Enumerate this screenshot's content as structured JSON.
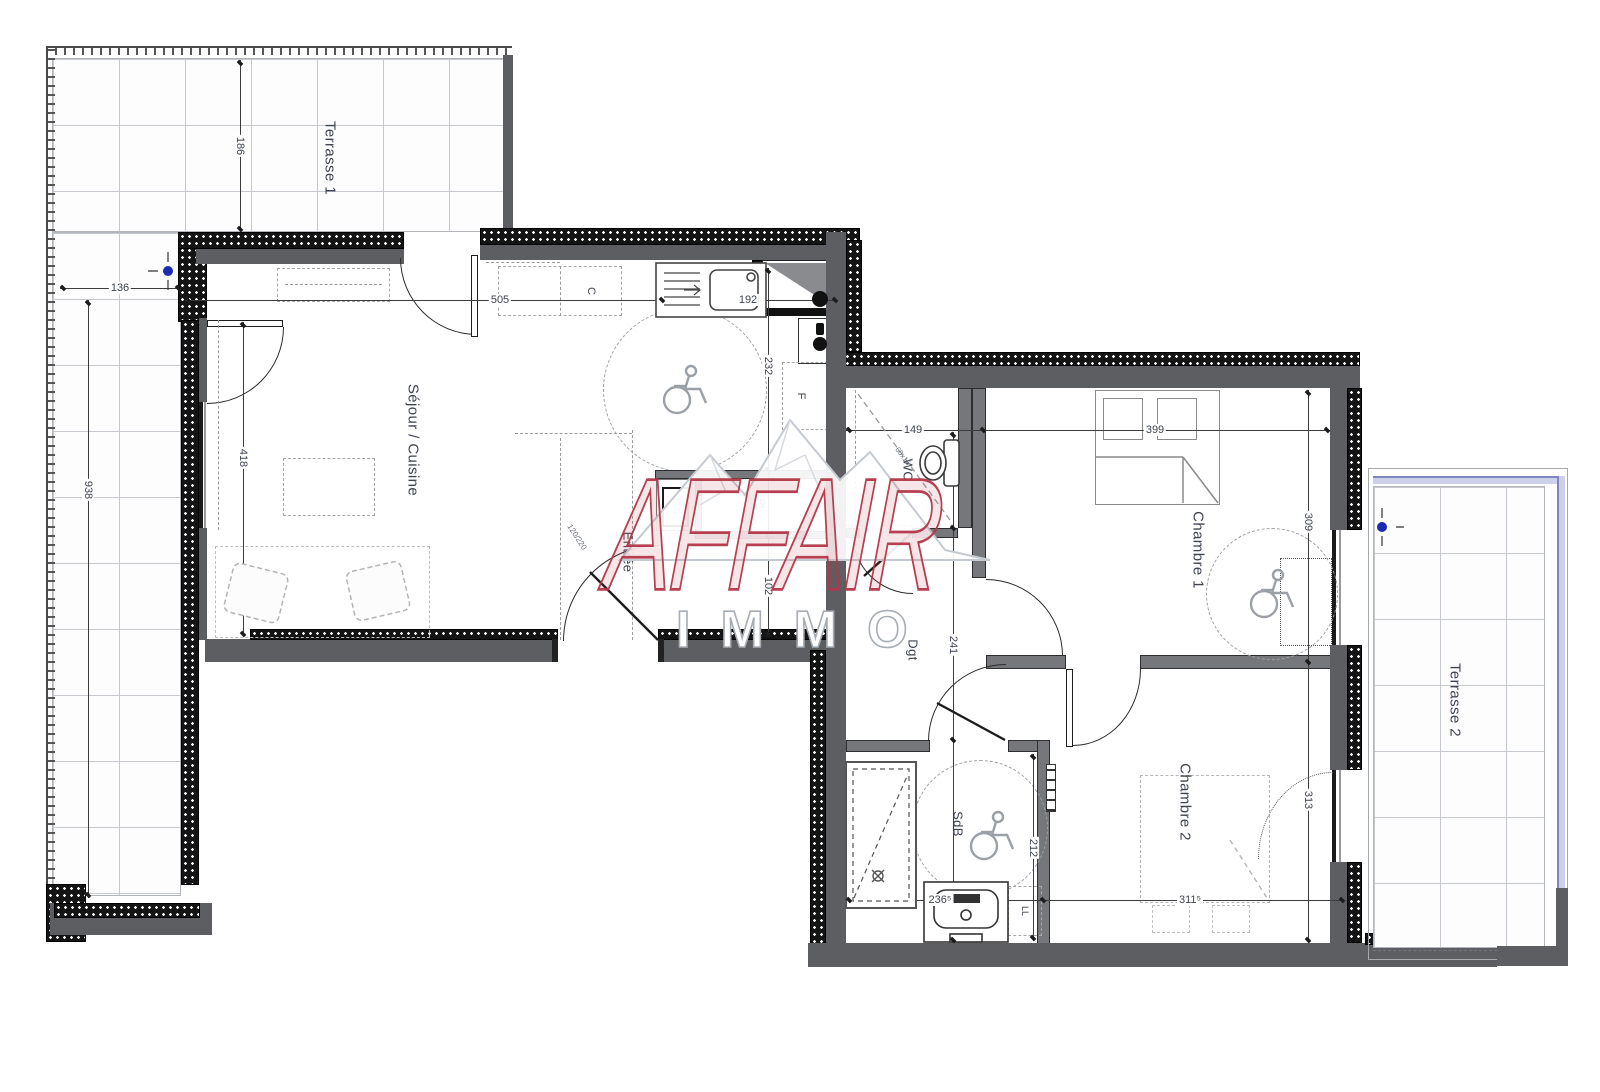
{
  "watermark": {
    "brand": "AFFAIR",
    "subtitle": "IMMO",
    "brand_color": "#b23648"
  },
  "rooms": {
    "terrasse1": "Terrasse 1",
    "sejour": "Séjour / Cuisine",
    "entree": "Entrée",
    "wc": "WC",
    "chambre1": "Chambre 1",
    "degagement": "Dgt",
    "sdb": "SdB",
    "chambre2": "Chambre 2",
    "terrasse2": "Terrasse 2"
  },
  "labels": {
    "kitchen_unit": "C",
    "fridge": "F",
    "closet": "PL",
    "electrical_box": "ETEL",
    "laundry": "LL",
    "entry_door_size": "120/220",
    "wc_duct": "60x16"
  },
  "dims": {
    "terrace1_top": "186",
    "terrace1_offset": "136",
    "terrace1_height": "938",
    "sejour_width": "505",
    "kitchen_sink_width": "192",
    "kitchen_depth": "232",
    "entree_gap": "102",
    "sejour_height": "418",
    "wc_width": "149",
    "chambre1_width": "399",
    "chambre1_height": "309",
    "degagement_height": "241",
    "sdb_height": "212",
    "chambre2_height": "313",
    "sdb_width": "236⁵",
    "chambre2_width": "311⁵"
  }
}
